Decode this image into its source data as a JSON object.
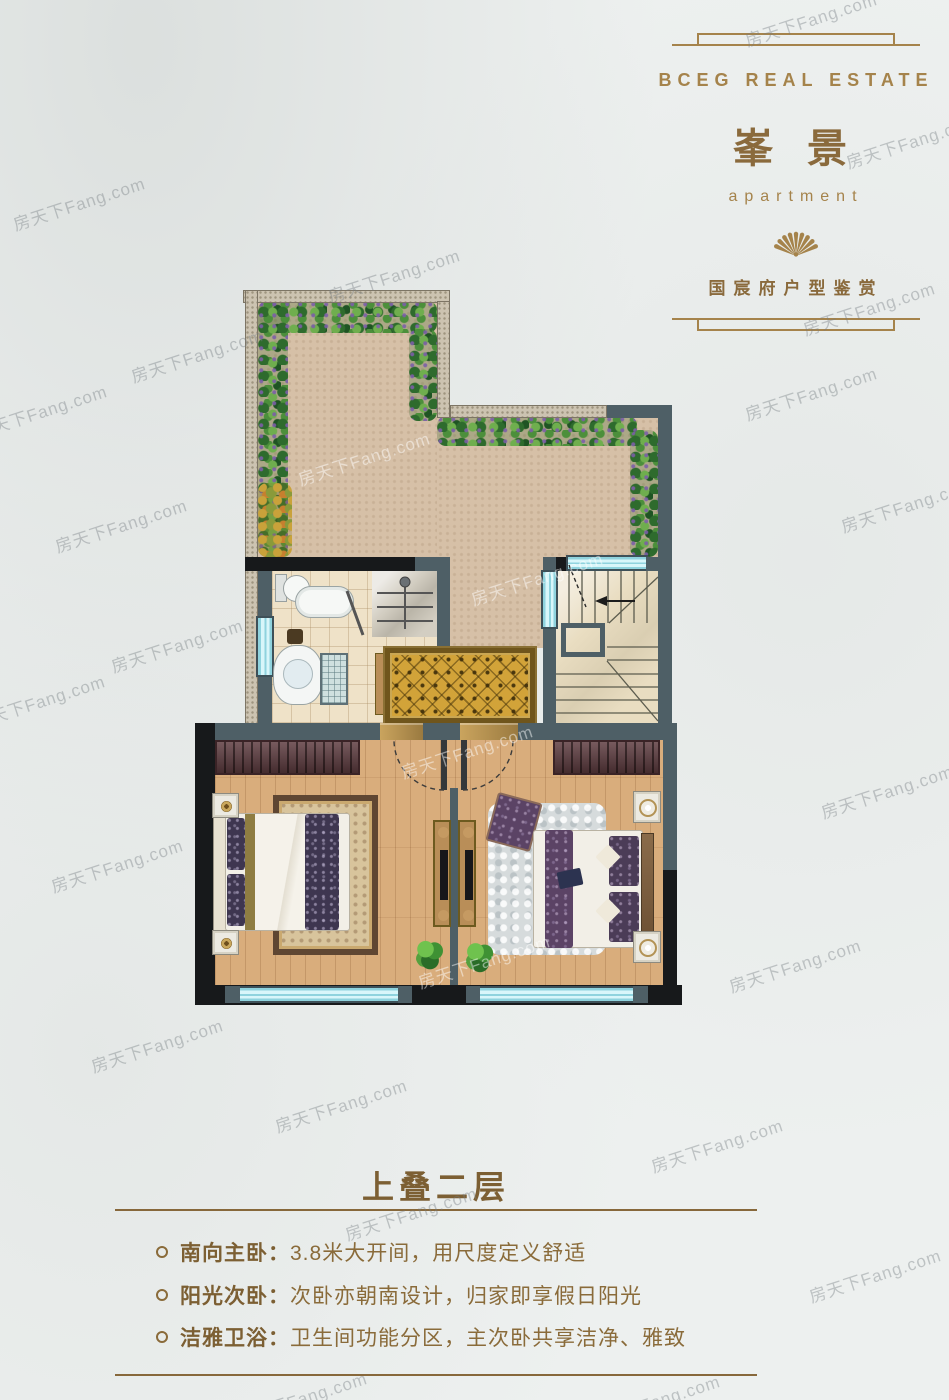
{
  "header": {
    "brand": "BCEG REAL ESTATE",
    "title": "峯 景",
    "subtitle": "apartment",
    "tagline": "国宸府户型鉴赏",
    "fan_icon": "folding-fan",
    "accent_color": "#a5834b"
  },
  "section": {
    "title": "上叠二层",
    "bullets": [
      {
        "label": "南向主卧：",
        "text": "3.8米大开间，用尺度定义舒适"
      },
      {
        "label": "阳光次卧：",
        "text": "次卧亦朝南设计，归家即享假日阳光"
      },
      {
        "label": "洁雅卫浴：",
        "text": "卫生间功能分区，主次卧共享洁净、雅致"
      }
    ]
  },
  "watermark": {
    "text": "房天下Fang.com"
  },
  "floorplan": {
    "name": "upper-duplex-second-floor",
    "regions": [
      "roof-terrace-garden",
      "bathroom",
      "staircase",
      "hallway",
      "master-bedroom",
      "second-bedroom"
    ],
    "colors": {
      "wall_slate": "#4e5f66",
      "wall_black": "#17191b",
      "window_cyan": "#bfeef2",
      "terrace_floor": "#d6c0a7",
      "wood_floor": "#d9ad7c",
      "hall_rug_gold": "#d2a339",
      "stair_floor": "#e9ddc1"
    }
  }
}
